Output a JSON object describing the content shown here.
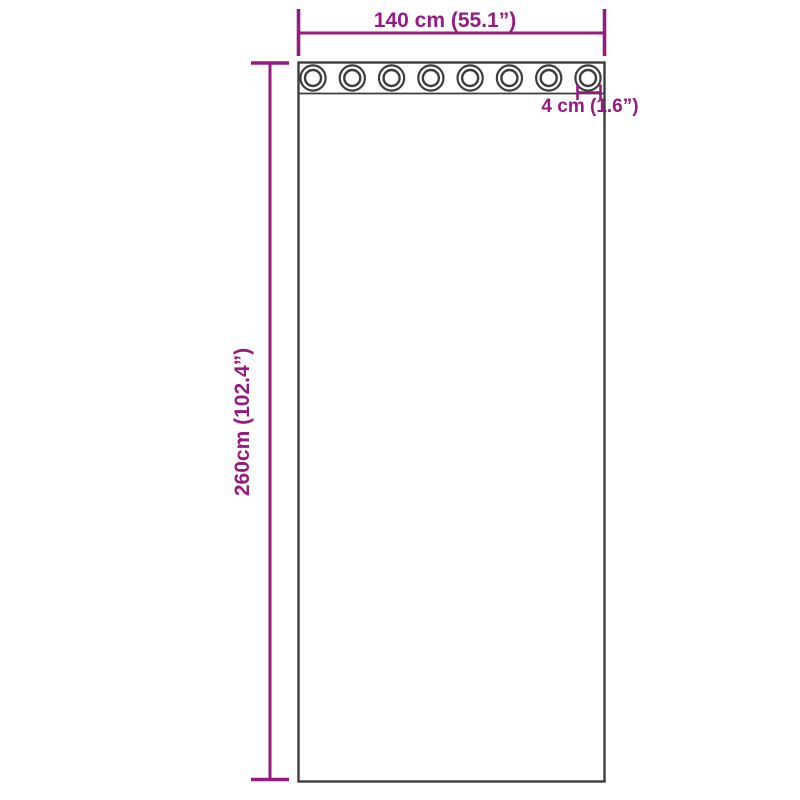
{
  "diagram": {
    "title": "curtain-with-grommets-dimension-diagram",
    "width_label": "140 cm (55.1”)",
    "height_label": "260cm (102.4”)",
    "grommet_label": "4 cm (1.6”)",
    "grommet_count": 8
  },
  "colors": {
    "dimension_accent": "#951b81",
    "outline": "#3d3d3d",
    "background": "#ffffff"
  }
}
